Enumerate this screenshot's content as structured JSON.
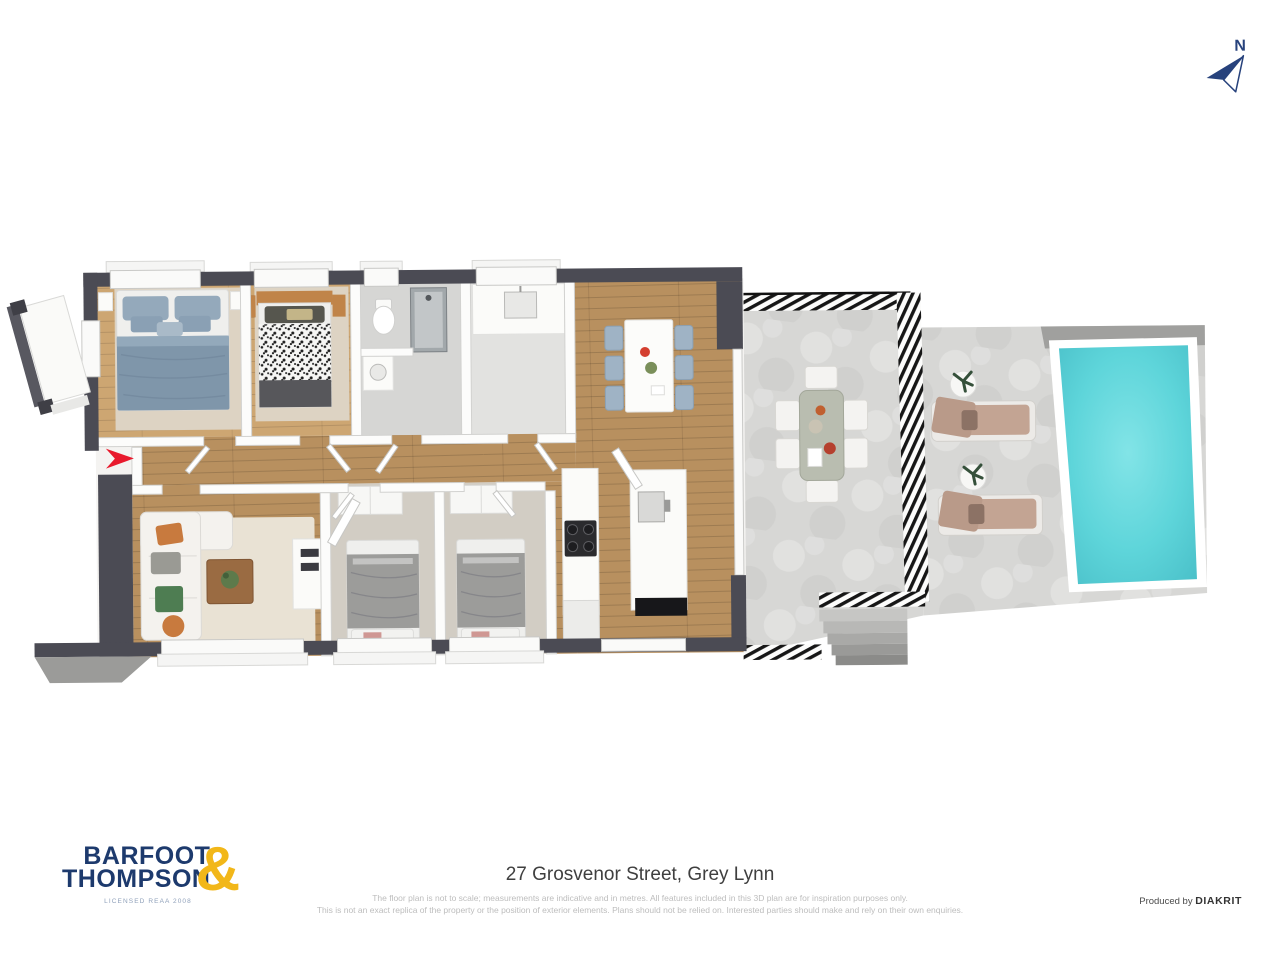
{
  "compass": {
    "label": "N"
  },
  "logo": {
    "word1": "BARFOOT",
    "word2": "THOMPSON",
    "ampersand": "&",
    "licence": "LICENSED REAA 2008"
  },
  "footer": {
    "address": "27 Grosvenor Street, Grey Lynn",
    "disclaimer_line1": "The floor plan is not to scale; measurements are indicative and in metres. All features included in this 3D plan are for inspiration purposes only.",
    "disclaimer_line2": "This is not an exact replica of the property or the position of exterior elements. Plans should not be relied on. Interested parties should make and rely on their own enquiries.",
    "credit_prefix": "Produced by ",
    "credit_brand": "DIAKRIT"
  },
  "colors": {
    "brand_navy": "#1d3a6d",
    "brand_yellow": "#f2b719",
    "wall_dark": "#4b4b54",
    "floor_wood": "#b8905f",
    "floor_wood_light": "#cda672",
    "carpet_beige": "#ddd3c3",
    "concrete_light": "#d7d7d5",
    "pool_surround": "#a0a09e",
    "pool_water": "#5ed5da",
    "water_light": "#82e4e7",
    "water_deep": "#49bfc8",
    "bed_blue": "#7f96aa",
    "pillow_blue": "#94a9bb",
    "chair_blue": "#9fb3c5",
    "sofa_cream": "#f4f2ee",
    "accent_orange": "#c87a3e",
    "lounger_tan": "#c3a493",
    "arrow_red": "#e8192c",
    "compass_navy": "#27427c"
  }
}
